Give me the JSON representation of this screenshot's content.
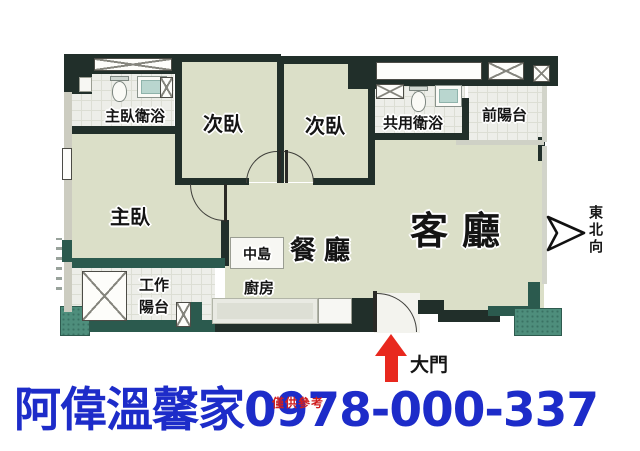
{
  "canvas": {
    "width": 640,
    "height": 451,
    "background": "#ffffff"
  },
  "floorplan": {
    "rooms": {
      "master_bath": "主臥衛浴",
      "bedroom_a": "次臥",
      "bedroom_b": "次臥",
      "shared_bath": "共用衛浴",
      "front_balcony": "前陽台",
      "master_bedroom": "主臥",
      "living_room": "客廳",
      "dining_room": "餐廳",
      "island": "中島",
      "kitchen": "廚房",
      "work_balcony_line1": "工作",
      "work_balcony_line2": "陽台"
    },
    "entrance_label": "大門",
    "compass_label": "東北向",
    "icons": {
      "toilet": "toilet-icon",
      "sink": "sink-icon",
      "washer": "washer-x-icon",
      "window": "window-x-icon",
      "door_arc": "door-swing-arc",
      "compass": "northeast-arrow-icon",
      "entrance_arrow": "entrance-arrow-icon"
    },
    "colors": {
      "wall_dark": "#212f2a",
      "wall_teal": "#2b5a4e",
      "pillar_teal": "#4e8e7c",
      "room_floor": "#dbdfc8",
      "tile_floor": "#edeee9",
      "arrow_red": "#e8281e"
    }
  },
  "footer": {
    "agency": "阿偉溫馨家",
    "phone": "0978-000-337",
    "watermark": "僅供參考",
    "text_color": "#1d2cc9"
  }
}
